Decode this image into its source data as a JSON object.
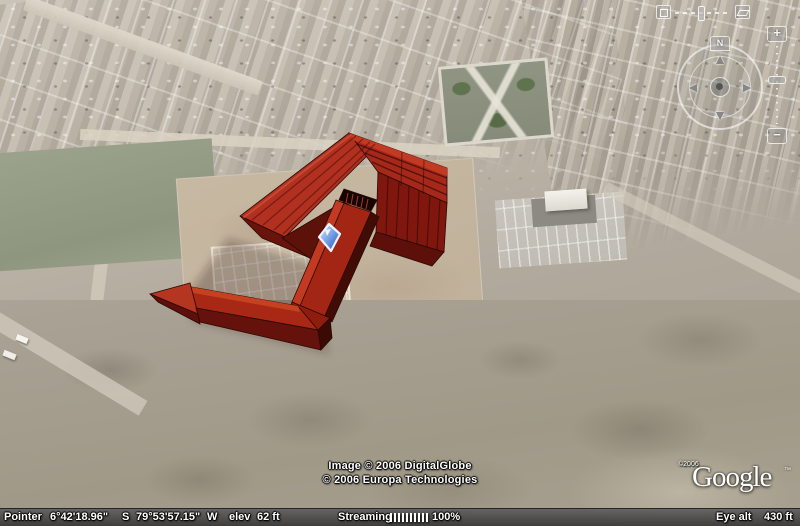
{
  "app": {
    "name": "Google Earth 3D viewport"
  },
  "colors": {
    "building_red": "#b1301f",
    "building_dark_red": "#7f170e",
    "ramp_red": "#a32513",
    "placemark_blue": "#2c5fd0",
    "status_bar_bg": "#4a4a4a"
  },
  "icons": {
    "pan_up": "▲",
    "pan_down": "▼",
    "pan_left": "◄",
    "pan_right": "►"
  },
  "navigation": {
    "north_label": "N",
    "zoom_in_label": "+",
    "zoom_out_label": "−"
  },
  "map_overlay": {
    "copyright_line1": "Image © 2006 DigitalGlobe",
    "copyright_line2": "© 2006 Europa Technologies",
    "logo_copyright": "©2006",
    "logo_text": "Google",
    "logo_tm": "™"
  },
  "status_bar": {
    "pointer_label": "Pointer",
    "latitude": "6°42'18.96\"",
    "latitude_hemisphere": "S",
    "longitude": "79°53'57.15\"",
    "longitude_hemisphere": "W",
    "elevation_label": "elev",
    "elevation_value": "62 ft",
    "streaming_label": "Streaming",
    "streaming_percent": "100%",
    "eye_alt_label": "Eye alt",
    "eye_alt_value": "430 ft"
  }
}
